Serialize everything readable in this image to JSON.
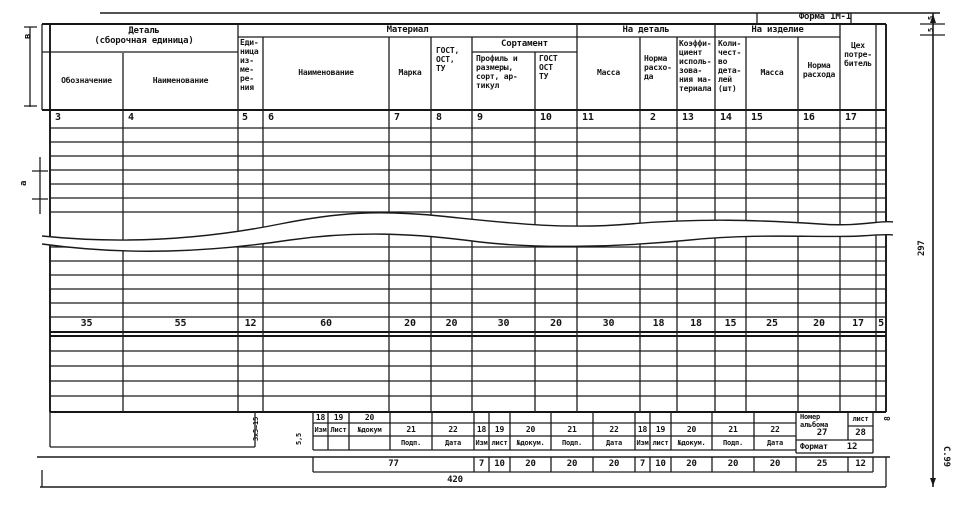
{
  "form": {
    "caption": "Форма 1М-1",
    "page_ref": "С.99"
  },
  "header": {
    "groups": {
      "detail": "Деталь\n(сборочная единица)",
      "material": "Материал",
      "sortament": "Сортамент",
      "per_detail": "На деталь",
      "per_item": "На изделие"
    },
    "cols": {
      "designation": "Обозначение",
      "name": "Наименование",
      "unit": "Еди-\nница\nиз-\nме-\nре-\nния",
      "mat_name": "Наименование",
      "grade": "Марка",
      "gost": "ГОСТ,\nОСТ,\nТУ",
      "profile": "Профиль и\nразмеры,\nсорт, ар-\nтикул",
      "gost2": "ГОСТ\nОСТ\nТУ",
      "mass": "Масса",
      "norm": "Норма\nрасхо-\nда",
      "coeff": "Коэффи-\nциент\nисполь-\nзова-\nния ма-\nтериала",
      "qty": "Коли-\nчест-\nво\nдета-\nлей\n(шт)",
      "mass2": "Масса",
      "norm2": "Норма\nрасхода",
      "shop": "Цех\nпотре-\nбитель"
    },
    "col_numbers": [
      "3",
      "4",
      "5",
      "6",
      "7",
      "8",
      "9",
      "10",
      "11",
      "2",
      "13",
      "14",
      "15",
      "16",
      "17"
    ]
  },
  "dims": {
    "col_widths": [
      "35",
      "55",
      "12",
      "60",
      "20",
      "20",
      "30",
      "20",
      "30",
      "18",
      "18",
      "15",
      "25",
      "20",
      "17",
      "5"
    ],
    "bottom": [
      "77",
      "7",
      "10",
      "20",
      "20",
      "20",
      "7",
      "10",
      "20",
      "20",
      "20",
      "25",
      "12"
    ],
    "total": "420",
    "height": "297",
    "a": "а",
    "b": "в",
    "five_a": "5",
    "five_b": "5",
    "block": "3x5=15",
    "row": "5,5",
    "eight": "8"
  },
  "revision": {
    "numbers": [
      "18",
      "19",
      "20",
      "21",
      "22"
    ],
    "labels": [
      "Изм",
      "Лист",
      "№докум",
      "Подп.",
      "Дата"
    ],
    "labels2": [
      "Изм",
      "лист",
      "№докум.",
      "Подп.",
      "Дата"
    ],
    "album_label": "Номер\nальбома",
    "album_num": "27",
    "sheet_label": "лист",
    "sheet_num": "28",
    "format_label": "Формат",
    "format_num": "12"
  }
}
